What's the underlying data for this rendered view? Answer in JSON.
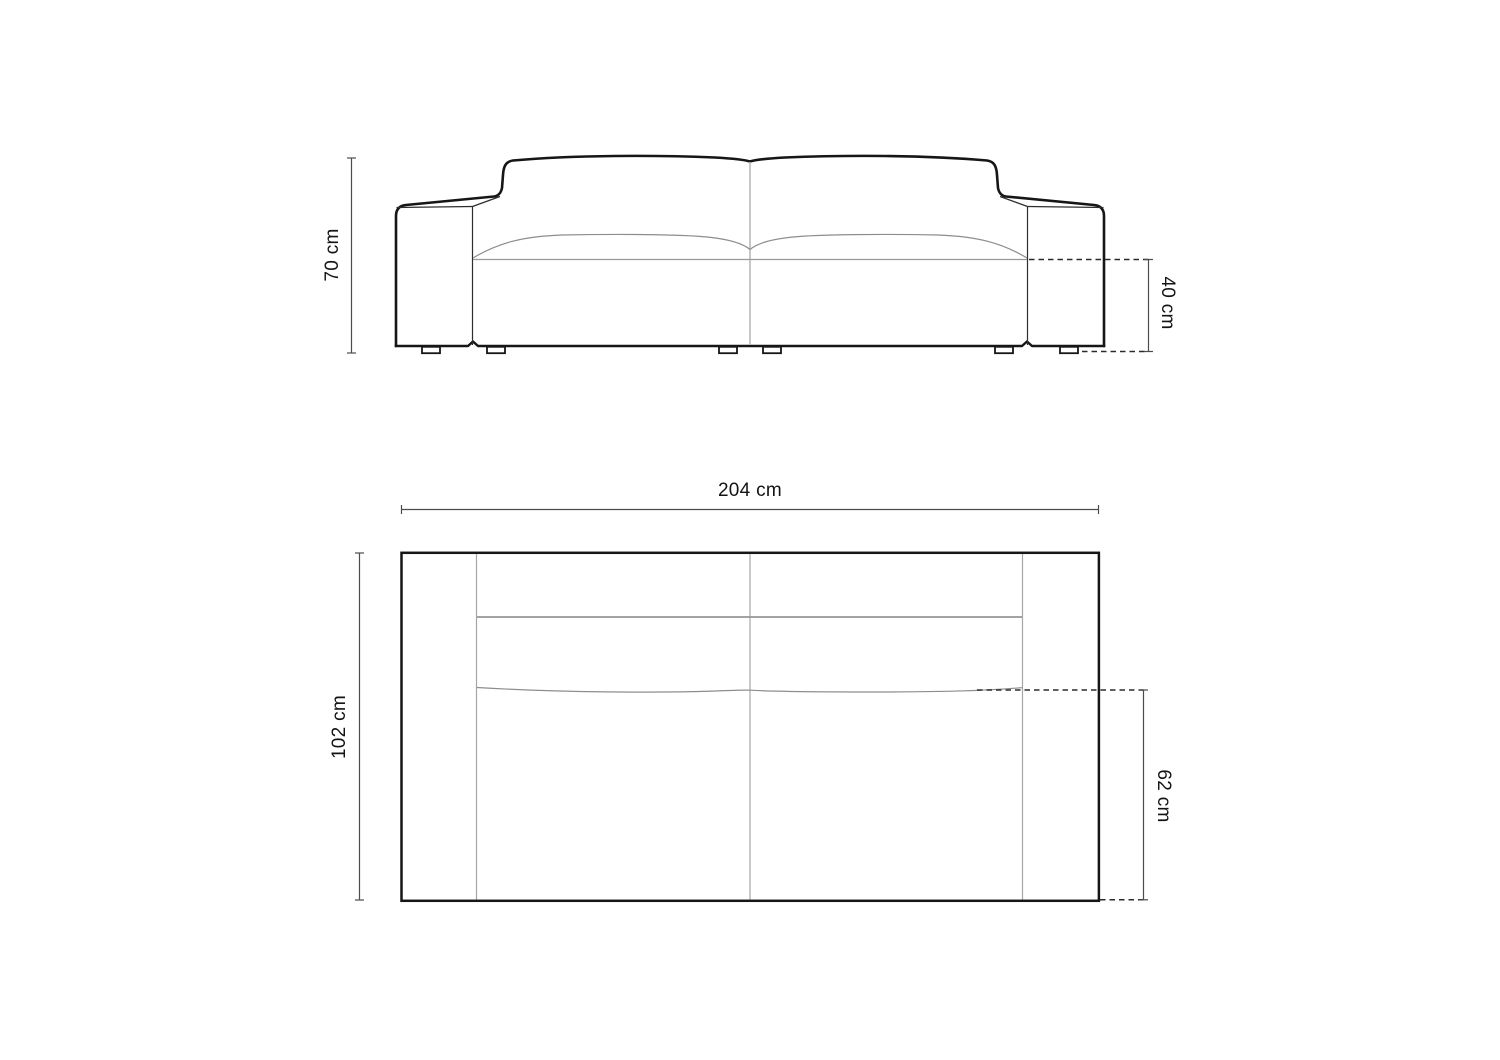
{
  "diagram": {
    "type": "furniture-dimension-drawing",
    "subject": "three-seater sofa",
    "views": {
      "front": {
        "labels": {
          "total_height": "70 cm",
          "seat_height": "40 cm"
        },
        "measurements": {
          "total_height_cm": 70,
          "seat_height_cm": 40
        }
      },
      "top": {
        "labels": {
          "total_width": "204 cm",
          "total_depth": "102 cm",
          "seat_depth": "62 cm"
        },
        "measurements": {
          "total_width_cm": 204,
          "total_depth_cm": 102,
          "seat_depth_cm": 62
        }
      }
    },
    "colors": {
      "background": "#ffffff",
      "outline": "#161616",
      "secondary_line": "#9a9a9a",
      "light_line": "#b9b9b9",
      "dimension_line": "#4c4c4c",
      "dashed_line": "#2b2b2b",
      "label_text": "#141414"
    }
  }
}
